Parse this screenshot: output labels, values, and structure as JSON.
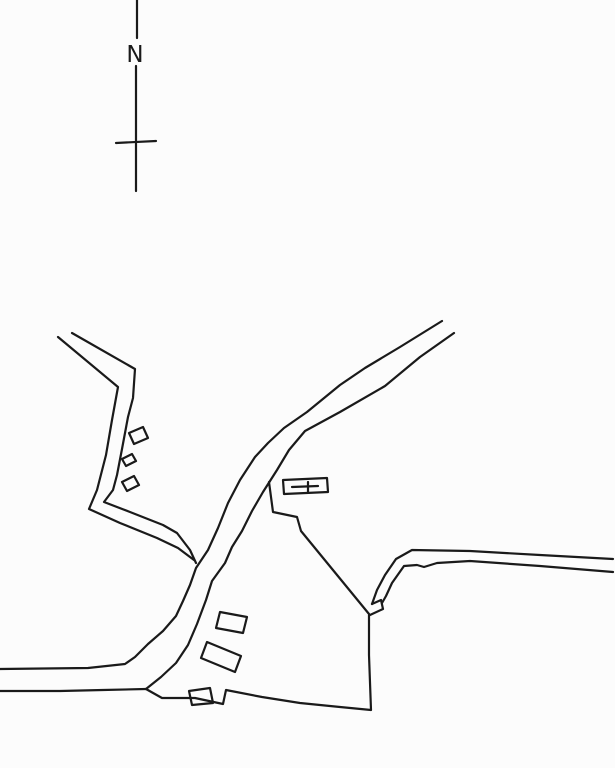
{
  "document": {
    "kind": "scanned hand-drawn site map",
    "visible_text": [
      "N"
    ]
  },
  "north_indicator": {
    "label": "N"
  },
  "colors": {
    "ink": "#1a1a1a",
    "paper": "#fcfcfc"
  },
  "map": {
    "default_stroke_width": 2.2,
    "paths": [
      {
        "name": "north-line-upper",
        "closed": false,
        "width": 2.4,
        "points": [
          [
            137,
            0
          ],
          [
            137,
            38
          ]
        ]
      },
      {
        "name": "north-line-lower",
        "closed": false,
        "width": 2.4,
        "points": [
          [
            136,
            66
          ],
          [
            136,
            191
          ]
        ]
      },
      {
        "name": "north-crossbar",
        "closed": false,
        "width": 3,
        "points": [
          [
            116,
            143
          ],
          [
            156,
            141
          ]
        ]
      },
      {
        "name": "main-road-west-edge",
        "closed": false,
        "points": [
          [
            442,
            321
          ],
          [
            400,
            347
          ],
          [
            365,
            368
          ],
          [
            340,
            385
          ],
          [
            307,
            412
          ],
          [
            284,
            428
          ],
          [
            268,
            443
          ],
          [
            255,
            457
          ],
          [
            240,
            480
          ],
          [
            228,
            503
          ],
          [
            218,
            528
          ],
          [
            208,
            550
          ],
          [
            196,
            568
          ],
          [
            190,
            585
          ],
          [
            183,
            601
          ],
          [
            176,
            616
          ],
          [
            163,
            631
          ],
          [
            148,
            644
          ],
          [
            135,
            657
          ],
          [
            125,
            664
          ],
          [
            88,
            668
          ],
          [
            0,
            669
          ]
        ]
      },
      {
        "name": "main-road-east-edge",
        "closed": false,
        "points": [
          [
            454,
            333
          ],
          [
            420,
            357
          ],
          [
            385,
            386
          ],
          [
            340,
            412
          ],
          [
            305,
            431
          ],
          [
            289,
            450
          ],
          [
            277,
            470
          ],
          [
            263,
            492
          ],
          [
            252,
            511
          ],
          [
            242,
            531
          ],
          [
            232,
            547
          ],
          [
            225,
            563
          ],
          [
            212,
            581
          ],
          [
            206,
            600
          ],
          [
            197,
            624
          ],
          [
            188,
            645
          ],
          [
            176,
            663
          ],
          [
            161,
            677
          ],
          [
            146,
            689
          ]
        ]
      },
      {
        "name": "left-road-inner-edge",
        "closed": false,
        "points": [
          [
            72,
            333
          ],
          [
            135,
            369
          ],
          [
            133,
            398
          ],
          [
            128,
            417
          ],
          [
            122,
            449
          ],
          [
            117,
            475
          ],
          [
            113,
            490
          ],
          [
            104,
            502
          ],
          [
            130,
            512
          ],
          [
            163,
            525
          ],
          [
            177,
            533
          ],
          [
            190,
            550
          ],
          [
            196,
            563
          ]
        ]
      },
      {
        "name": "left-road-outer-edge",
        "closed": false,
        "points": [
          [
            58,
            337
          ],
          [
            118,
            387
          ],
          [
            112,
            420
          ],
          [
            106,
            455
          ],
          [
            97,
            490
          ],
          [
            89,
            509
          ],
          [
            120,
            523
          ],
          [
            157,
            538
          ],
          [
            178,
            548
          ],
          [
            194,
            560
          ]
        ]
      },
      {
        "name": "bottom-road-south-edge",
        "closed": false,
        "points": [
          [
            0,
            691
          ],
          [
            60,
            691
          ],
          [
            103,
            690
          ],
          [
            146,
            689
          ]
        ]
      },
      {
        "name": "field-boundary-south",
        "closed": false,
        "points": [
          [
            146,
            689
          ],
          [
            162,
            698
          ],
          [
            195,
            698
          ],
          [
            223,
            704
          ],
          [
            226,
            690
          ],
          [
            262,
            697
          ],
          [
            300,
            703
          ],
          [
            340,
            707
          ],
          [
            371,
            710
          ],
          [
            369,
            655
          ],
          [
            369,
            615
          ]
        ]
      },
      {
        "name": "right-road-north-edge",
        "closed": false,
        "points": [
          [
            613,
            559
          ],
          [
            540,
            555
          ],
          [
            470,
            551
          ],
          [
            412,
            550
          ],
          [
            396,
            559
          ],
          [
            385,
            575
          ],
          [
            377,
            590
          ],
          [
            372,
            604
          ]
        ]
      },
      {
        "name": "right-road-end-hook",
        "closed": false,
        "points": [
          [
            372,
            604
          ],
          [
            381,
            600
          ],
          [
            383,
            609
          ],
          [
            370,
            615
          ]
        ]
      },
      {
        "name": "right-road-south-edge",
        "closed": false,
        "points": [
          [
            613,
            572
          ],
          [
            540,
            566
          ],
          [
            470,
            561
          ],
          [
            437,
            563
          ],
          [
            424,
            567
          ],
          [
            417,
            565
          ],
          [
            404,
            566
          ],
          [
            392,
            583
          ],
          [
            386,
            596
          ],
          [
            382,
            603
          ]
        ]
      },
      {
        "name": "churchyard-boundary",
        "closed": false,
        "points": [
          [
            269,
            482
          ],
          [
            273,
            512
          ],
          [
            297,
            517
          ],
          [
            301,
            531
          ],
          [
            369,
            614
          ]
        ]
      },
      {
        "name": "church-outline",
        "closed": true,
        "width": 2.6,
        "points": [
          [
            283,
            480
          ],
          [
            327,
            478
          ],
          [
            328,
            492
          ],
          [
            284,
            494
          ]
        ]
      },
      {
        "name": "church-cross-horizontal",
        "closed": false,
        "width": 2.4,
        "points": [
          [
            292,
            487
          ],
          [
            318,
            486
          ]
        ]
      },
      {
        "name": "church-cross-vertical",
        "closed": false,
        "width": 2.4,
        "points": [
          [
            308,
            482
          ],
          [
            308,
            492
          ]
        ]
      },
      {
        "name": "building-northwest-1",
        "closed": true,
        "width": 2.4,
        "points": [
          [
            129,
            433
          ],
          [
            143,
            427
          ],
          [
            148,
            438
          ],
          [
            134,
            444
          ]
        ]
      },
      {
        "name": "building-northwest-2",
        "closed": true,
        "width": 2.4,
        "points": [
          [
            122,
            459
          ],
          [
            132,
            454
          ],
          [
            136,
            461
          ],
          [
            126,
            466
          ]
        ]
      },
      {
        "name": "building-northwest-3",
        "closed": true,
        "width": 2.4,
        "points": [
          [
            122,
            482
          ],
          [
            134,
            476
          ],
          [
            139,
            485
          ],
          [
            127,
            491
          ]
        ]
      },
      {
        "name": "building-south-1",
        "closed": true,
        "width": 2.4,
        "points": [
          [
            220,
            612
          ],
          [
            247,
            617
          ],
          [
            243,
            633
          ],
          [
            216,
            628
          ]
        ]
      },
      {
        "name": "building-south-2",
        "closed": true,
        "width": 2.4,
        "points": [
          [
            207,
            642
          ],
          [
            241,
            656
          ],
          [
            235,
            672
          ],
          [
            201,
            658
          ]
        ]
      },
      {
        "name": "building-south-3",
        "closed": true,
        "width": 2.4,
        "points": [
          [
            189,
            691
          ],
          [
            210,
            688
          ],
          [
            213,
            703
          ],
          [
            192,
            705
          ]
        ]
      }
    ]
  }
}
